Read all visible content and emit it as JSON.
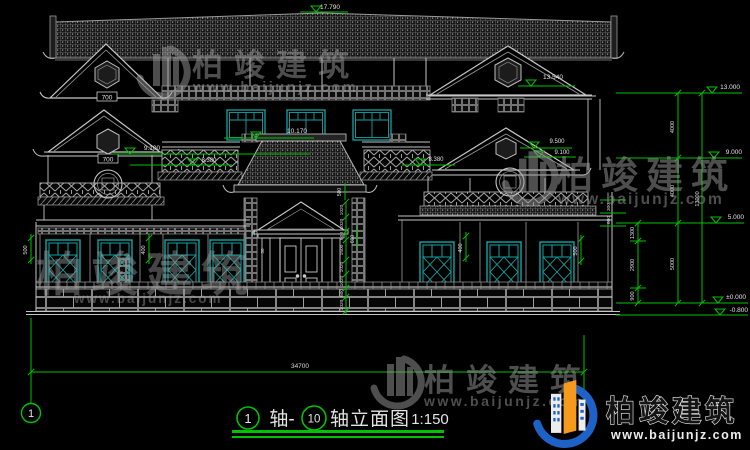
{
  "colors": {
    "background": "#000000",
    "line_main": "#c8c8c8",
    "line_dim": "#8f8f8f",
    "dim_green": "#00c200",
    "window_teal": "#13a3a3",
    "watermark_gray": "#9c9c9c",
    "logo_blue": "#1e62c8",
    "logo_orange": "#f49a1c",
    "text_white": "#e4e4e4"
  },
  "markers": {
    "ridge": "17.790",
    "gable_right_upper": "13.540",
    "eave_center": "10.170",
    "gable_left_lower": "9.100",
    "gable_right_a": "9.500",
    "gable_right_b": "9.100",
    "band_left": "8.380",
    "band_right": "8.380"
  },
  "levels": {
    "l13": "13.000",
    "l9": "9.000",
    "l5": "5.000",
    "l0": "±0.000",
    "lm08": "-0.800"
  },
  "right_dims": {
    "seg1": "4000",
    "seg2": "4000",
    "seg3": "5000",
    "total": "13000",
    "sub1": "1300",
    "sub2": "2900",
    "sub3": "900",
    "eave1": "300",
    "eave2": "600"
  },
  "bottom_dim": {
    "total": "34700"
  },
  "facade_dims": {
    "left_overhang": "500",
    "left_bay": "400",
    "right_bay": "400",
    "right_overhang": "500",
    "door_side": "600",
    "eave_drop": "500",
    "tiny_a": "30",
    "tiny_b": "30",
    "hex_left_upper": "700",
    "hex_left_lower": "700",
    "door_chain": [
      "1020",
      "1020",
      "600",
      "1500",
      "1020",
      "1020",
      "600",
      "1020"
    ]
  },
  "axis": {
    "left": "1"
  },
  "title_block": {
    "axis_start": "1",
    "join": "轴-",
    "axis_end": "10",
    "name": "轴立面图",
    "scale": "1:150"
  },
  "watermark": {
    "brand": "柏竣建筑",
    "url": "www.baijunjz.com"
  }
}
